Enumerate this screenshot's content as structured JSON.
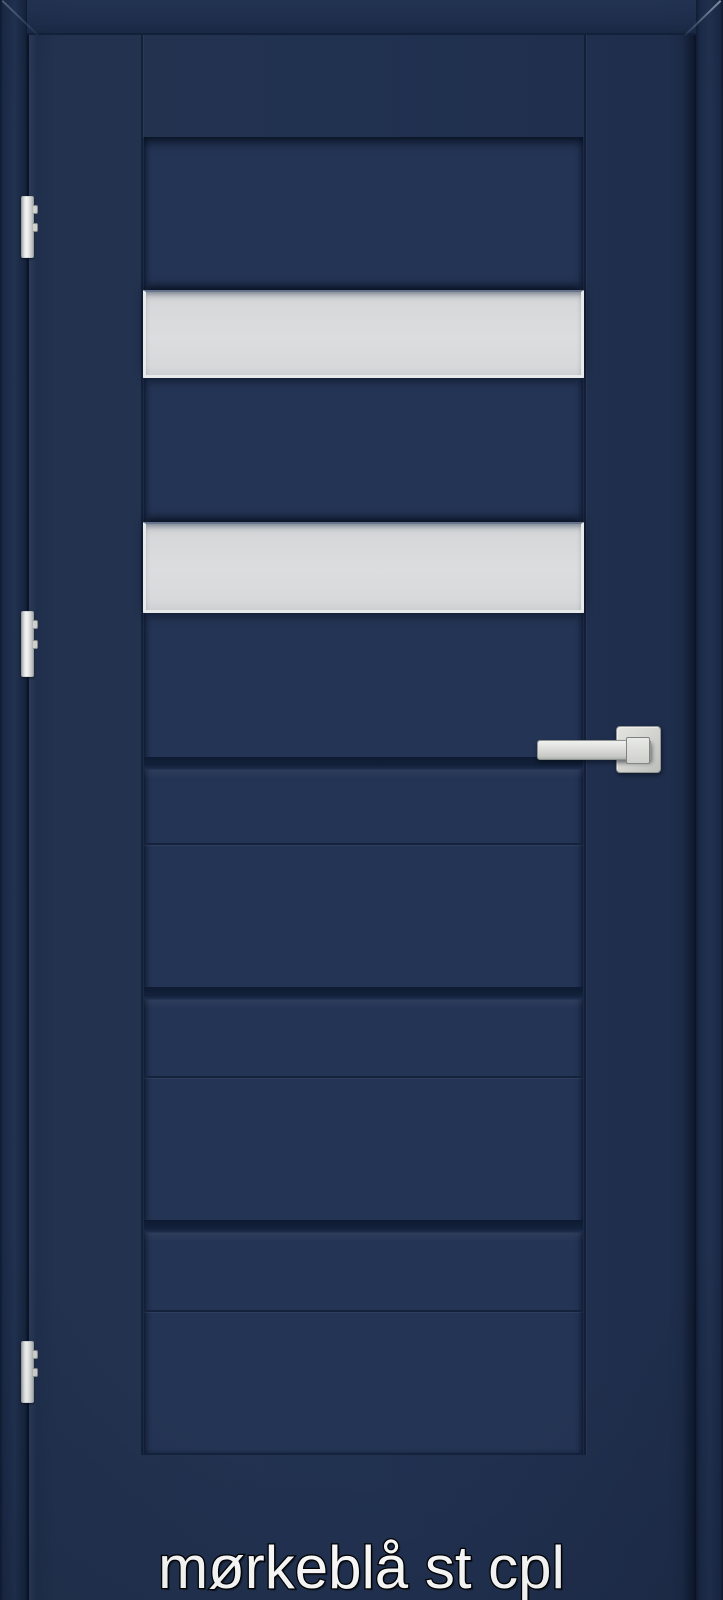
{
  "caption": {
    "text": "mørkeblå st cpl"
  },
  "colors": {
    "frame": "#1d2b48",
    "leaf": "#213150",
    "panel": "#243454",
    "groove": "#101d35",
    "glass": "#d9dadb",
    "glass_border": "#e8e9ea",
    "metal": "#d4d5d3",
    "metal_dark": "#8c9094",
    "caption_fill": "#ffffff",
    "caption_outline": "#000000"
  },
  "door": {
    "glass_strips": 2,
    "groove_strips": 3,
    "hinges": 3,
    "handle": "square rosette lever"
  }
}
